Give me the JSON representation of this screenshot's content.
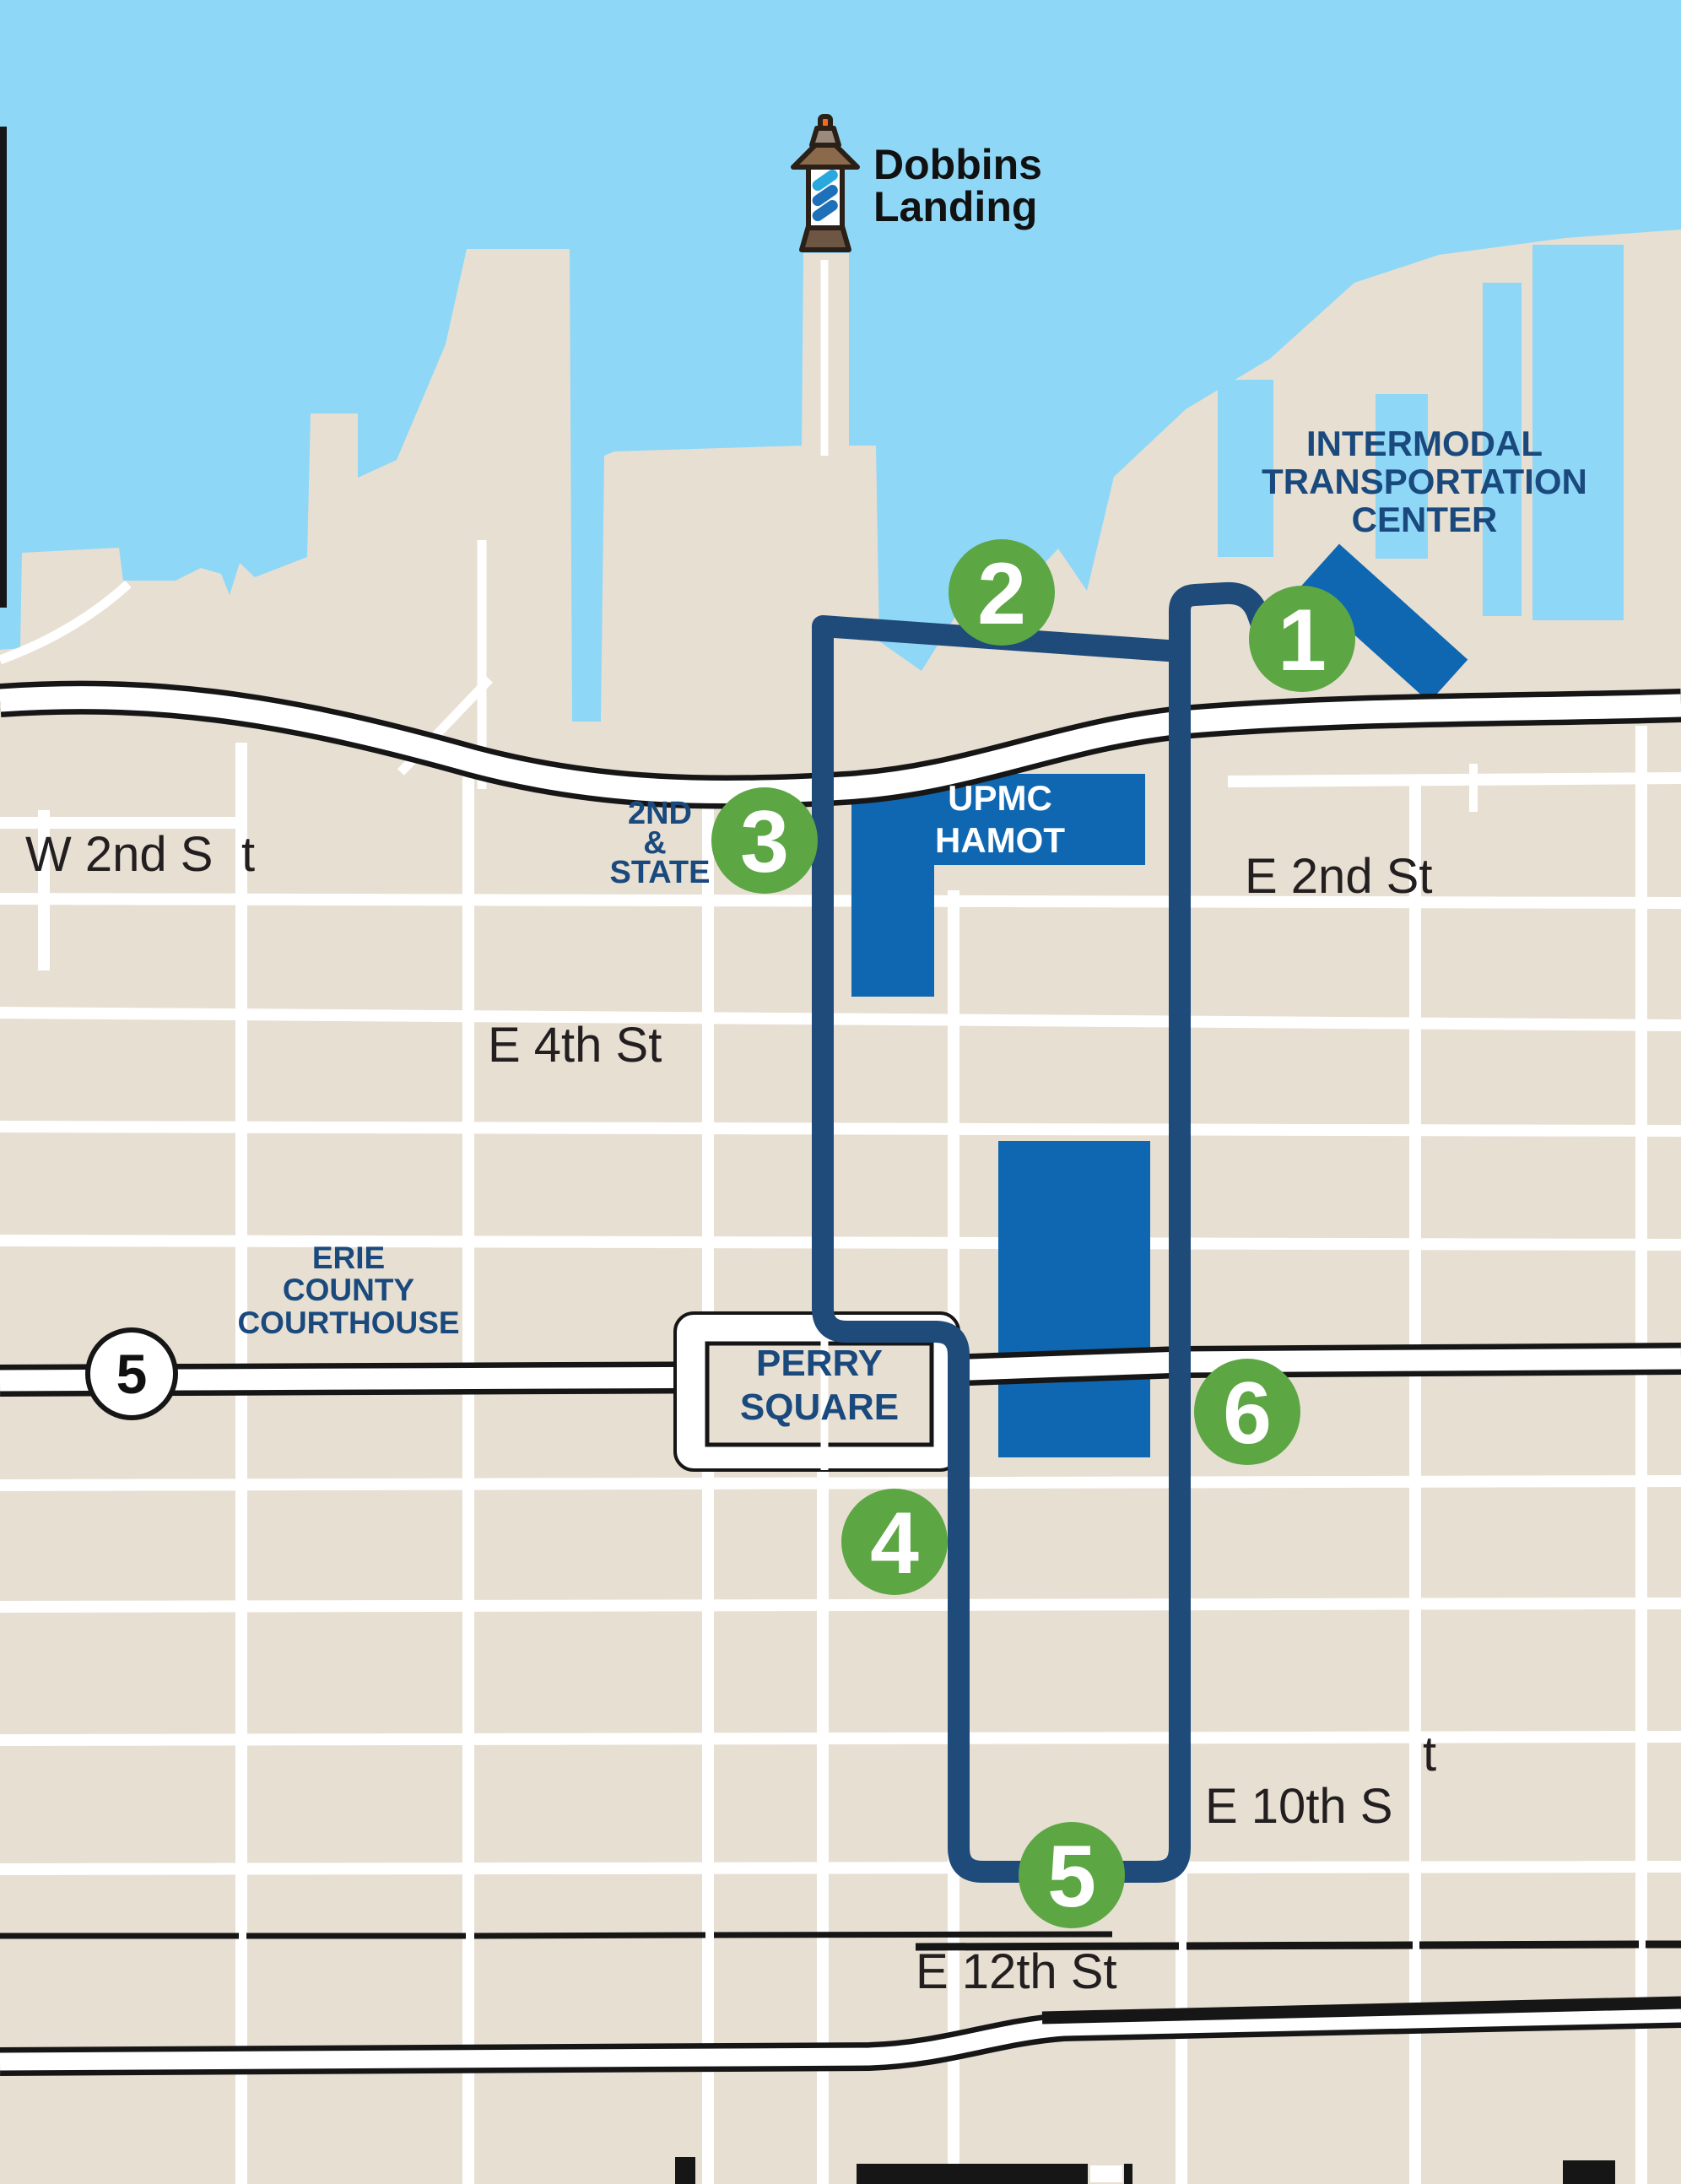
{
  "title": {
    "line1": "Dobbins",
    "line2": "Landing"
  },
  "landmarks": {
    "intermodal": {
      "line1": "INTERMODAL",
      "line2": "TRANSPORTATION",
      "line3": "CENTER"
    },
    "upmc": {
      "line1": "UPMC",
      "line2": "HAMOT"
    },
    "second_and_state": {
      "line1": "2ND",
      "line2": "&",
      "line3": "STATE"
    },
    "courthouse": {
      "line1": "ERIE",
      "line2": "COUNTY",
      "line3": "COURTHOUSE"
    },
    "perry_square": {
      "line1": "PERRY",
      "line2": "SQUARE"
    }
  },
  "streets": {
    "w2nd": {
      "part1": "W 2nd S",
      "part2": "t"
    },
    "e2nd": "E 2nd St",
    "e4th": "E 4th St",
    "e10th": {
      "part1": "E 10th S",
      "part2": "t"
    },
    "e12th": "E 12th St"
  },
  "route_shield": {
    "number": "5"
  },
  "stops": [
    {
      "number": "1"
    },
    {
      "number": "2"
    },
    {
      "number": "3"
    },
    {
      "number": "4"
    },
    {
      "number": "5"
    },
    {
      "number": "6"
    }
  ],
  "colors": {
    "water": "#8ed7f7",
    "land": "#e7dfd2",
    "street_white": "#ffffff",
    "route_navy": "#1e4b7a",
    "building_blue": "#0f67b1",
    "stop_green": "#5ca644",
    "label_navy": "#1a4a7d",
    "street_label": "#231f20",
    "road_black": "#161616",
    "lighthouse_light_blue": "#29a8e0",
    "lighthouse_mid_blue": "#1e71b8",
    "lighthouse_roof": "#8a6a4a",
    "lighthouse_cap": "#9b8b7d",
    "lighthouse_tip": "#f26a21"
  }
}
